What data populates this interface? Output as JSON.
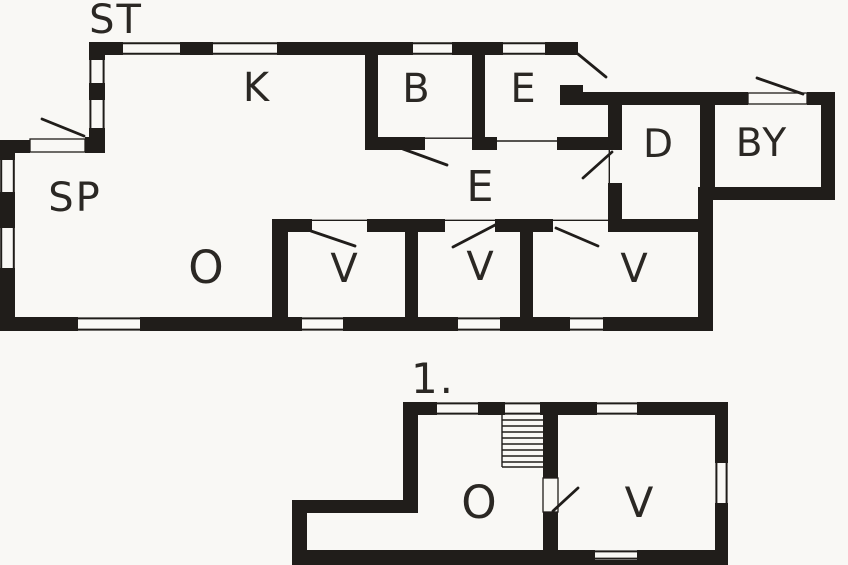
{
  "diagram": {
    "kind": "house-floor-plan",
    "floor_count_shown": 2
  },
  "colors": {
    "background": "#f9f8f5",
    "wall": "#201d1a",
    "text": "#2b2824"
  },
  "floors": {
    "ground": {
      "label": "ST",
      "rooms": {
        "k": "K",
        "b": "B",
        "e_entrance": "E",
        "sp": "SP",
        "e_hall": "E",
        "d": "D",
        "by": "BY",
        "o": "O",
        "v1": "V",
        "v2": "V",
        "v3": "V"
      }
    },
    "first": {
      "label": "1.",
      "rooms": {
        "o": "O",
        "v": "V"
      }
    }
  }
}
